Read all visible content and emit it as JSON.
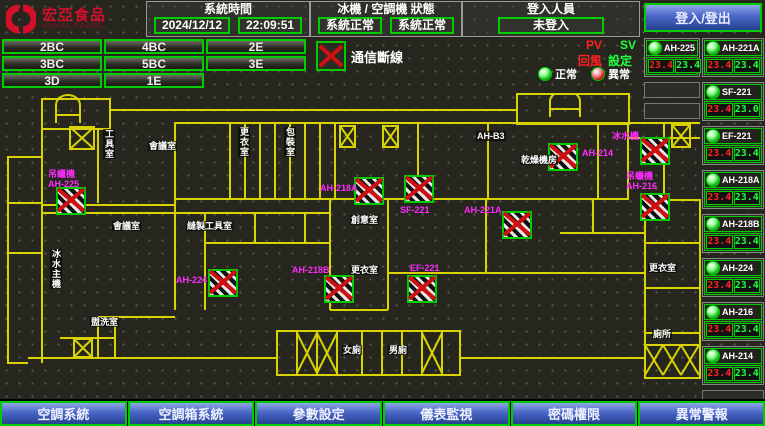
{
  "header": {
    "logo": {
      "name": "宏亞食品",
      "sub": "HUNYA FOODS"
    },
    "system_time": {
      "label": "系統時間",
      "date": "2024/12/12",
      "time": "22:09:51"
    },
    "machine_status": {
      "label": "冰機 / 空調機 狀態",
      "chiller": "系統正常",
      "ahu": "系統正常"
    },
    "login": {
      "label": "登入人員",
      "value": "未登入",
      "button": "登入/登出"
    }
  },
  "floor_buttons": [
    "2BC",
    "4BC",
    "2E",
    "3BC",
    "5BC",
    "3E",
    "3D",
    "1E"
  ],
  "comm_legend": {
    "label": "通信斷線"
  },
  "pv_sv": {
    "pv": "PV",
    "sv": "SV",
    "pv_desc": "回風",
    "sv_desc": "設定"
  },
  "status_legend": {
    "normal": "正常",
    "abnormal": "異常"
  },
  "units_left": [
    {
      "name": "AH-225",
      "pv": "23.4",
      "sv": "23.4"
    }
  ],
  "units_right": [
    {
      "name": "AH-221A",
      "pv": "23.4",
      "sv": "23.4"
    },
    {
      "name": "SF-221",
      "pv": "23.4",
      "sv": "23.0"
    },
    {
      "name": "EF-221",
      "pv": "23.4",
      "sv": "23.4"
    },
    {
      "name": "AH-218A",
      "pv": "23.4",
      "sv": "23.4"
    },
    {
      "name": "AH-218B",
      "pv": "23.4",
      "sv": "23.4"
    },
    {
      "name": "AH-224",
      "pv": "23.4",
      "sv": "23.4"
    },
    {
      "name": "AH-216",
      "pv": "23.4",
      "sv": "23.4"
    },
    {
      "name": "AH-214",
      "pv": "23.4",
      "sv": "23.4"
    }
  ],
  "floorplan": {
    "unit_labels": [
      {
        "lines": [
          "吊蠟機",
          "AH-225"
        ],
        "x": 48,
        "y": 76
      },
      {
        "lines": [
          "AH-224"
        ],
        "x": 176,
        "y": 182
      },
      {
        "lines": [
          "AH-218A"
        ],
        "x": 320,
        "y": 90
      },
      {
        "lines": [
          "SF-221"
        ],
        "x": 400,
        "y": 112
      },
      {
        "lines": [
          "AH-218B"
        ],
        "x": 292,
        "y": 172
      },
      {
        "lines": [
          "EF-221"
        ],
        "x": 410,
        "y": 170
      },
      {
        "lines": [
          "AH-221A"
        ],
        "x": 464,
        "y": 112
      },
      {
        "lines": [
          "AH-214"
        ],
        "x": 582,
        "y": 55
      },
      {
        "lines": [
          "吊蠟機",
          "AH-216"
        ],
        "x": 626,
        "y": 78
      },
      {
        "lines": [
          "冰水機"
        ],
        "x": 612,
        "y": 38
      }
    ],
    "room_labels": [
      {
        "text": "工具室",
        "x": 103,
        "y": 36,
        "vertical": true
      },
      {
        "text": "會議室",
        "x": 148,
        "y": 48
      },
      {
        "text": "更衣室",
        "x": 238,
        "y": 34,
        "vertical": true
      },
      {
        "text": "包裝室",
        "x": 284,
        "y": 34,
        "vertical": true
      },
      {
        "text": "AH-B3",
        "x": 476,
        "y": 38
      },
      {
        "text": "乾燥機房",
        "x": 520,
        "y": 62
      },
      {
        "text": "會議室",
        "x": 112,
        "y": 128
      },
      {
        "text": "縫製工具室",
        "x": 186,
        "y": 128
      },
      {
        "text": "冰水主機",
        "x": 50,
        "y": 156,
        "vertical": true
      },
      {
        "text": "創意室",
        "x": 350,
        "y": 122
      },
      {
        "text": "更衣室",
        "x": 350,
        "y": 172
      },
      {
        "text": "盥洗室",
        "x": 90,
        "y": 224
      },
      {
        "text": "女廁",
        "x": 342,
        "y": 252
      },
      {
        "text": "男廁",
        "x": 388,
        "y": 252
      },
      {
        "text": "更衣室",
        "x": 648,
        "y": 170
      },
      {
        "text": "廁所",
        "x": 652,
        "y": 236
      }
    ],
    "fail_icons": [
      {
        "x": 56,
        "y": 94
      },
      {
        "x": 208,
        "y": 176
      },
      {
        "x": 354,
        "y": 84
      },
      {
        "x": 404,
        "y": 82
      },
      {
        "x": 324,
        "y": 182
      },
      {
        "x": 407,
        "y": 182
      },
      {
        "x": 502,
        "y": 118
      },
      {
        "x": 548,
        "y": 50
      },
      {
        "x": 640,
        "y": 100
      },
      {
        "x": 640,
        "y": 44
      }
    ]
  },
  "nav_buttons": [
    "空調系統",
    "空調箱系統",
    "參數設定",
    "儀表監視",
    "密碼權限",
    "異常警報"
  ],
  "colors": {
    "accent_green": "#00cc00",
    "wall_yellow": "#d8d300",
    "unit_magenta": "#ff2bff",
    "pv_red": "#ff2020",
    "sv_green": "#20ff40",
    "nav_blue": "#4a66c8",
    "logo_red": "#d40f2a"
  }
}
